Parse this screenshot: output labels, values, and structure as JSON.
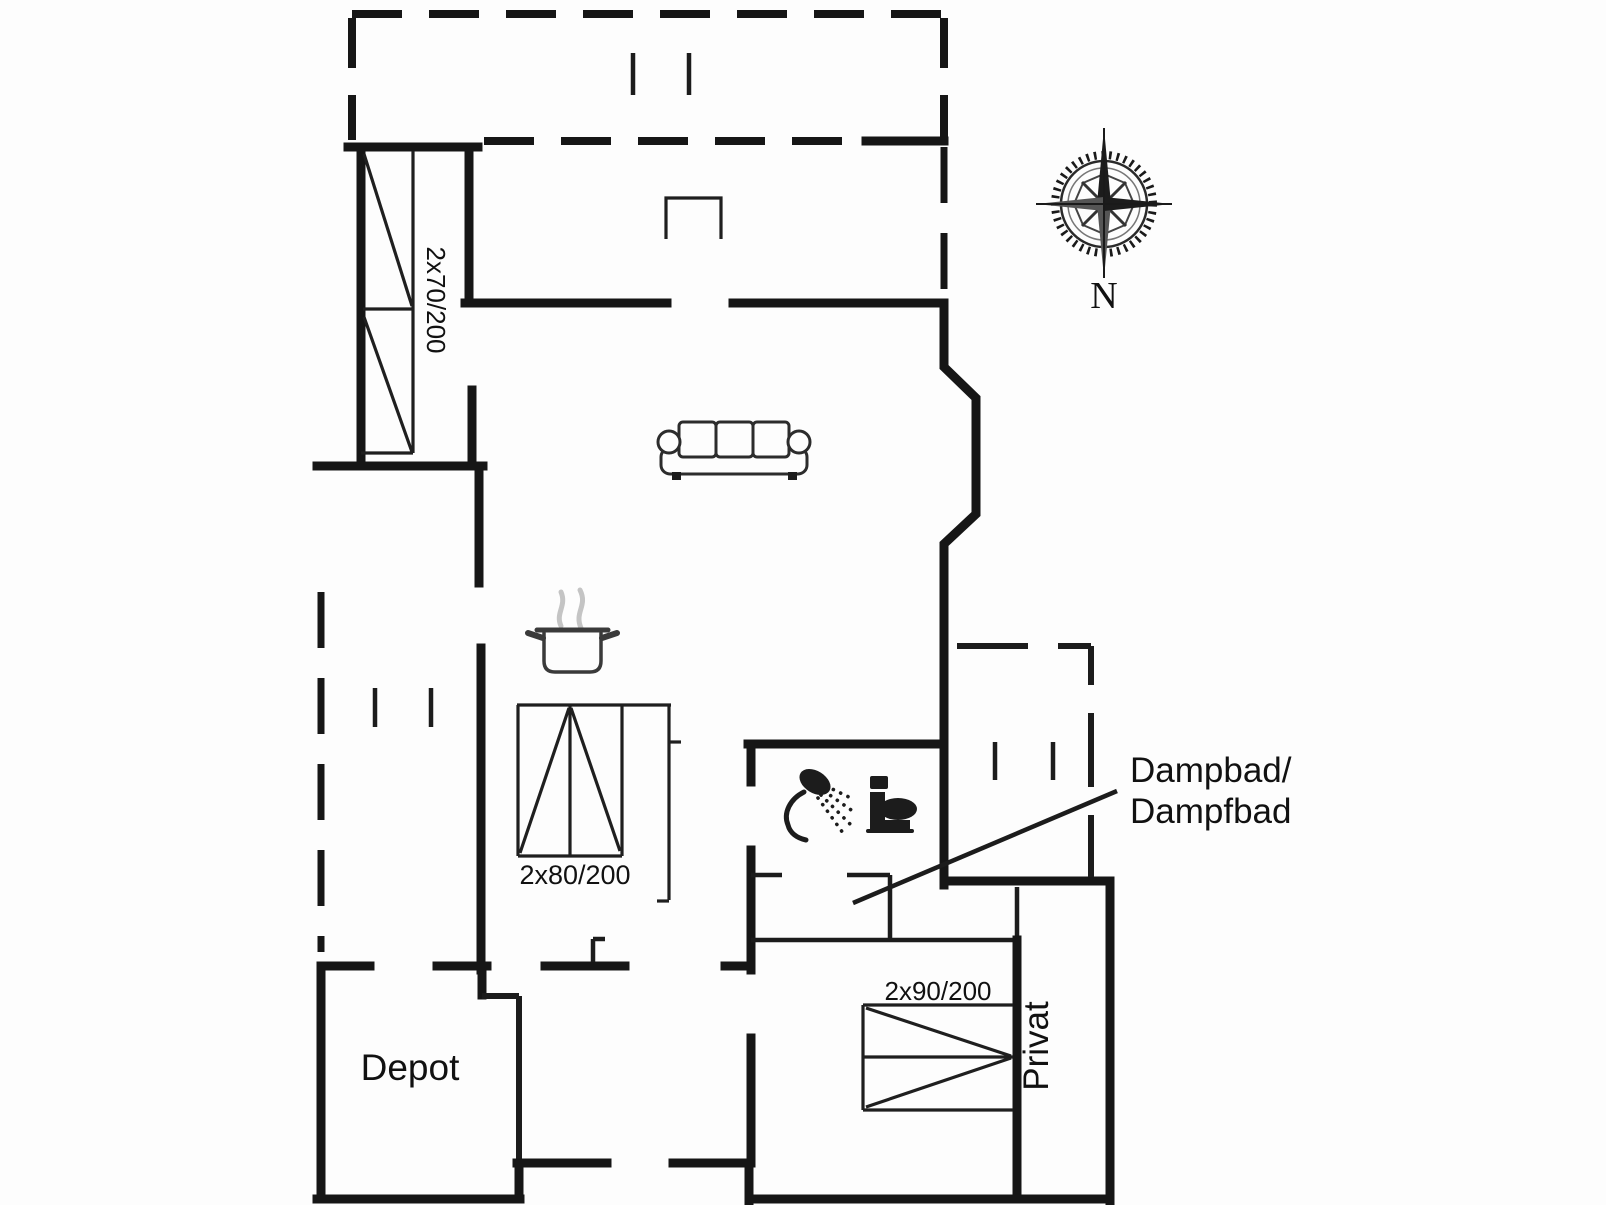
{
  "labels": {
    "window_left": "2x70/200",
    "bed_small": "2x80/200",
    "bed_large": "2x90/200",
    "room_depot": "Depot",
    "room_privat": "Privat",
    "annotation_line1": "Dampbad/",
    "annotation_line2": "Dampfbad",
    "compass_north": "N"
  },
  "icons": {
    "compass": "compass-rose-icon",
    "sofa": "sofa-icon",
    "stove": "cooking-pot-icon",
    "shower": "shower-icon",
    "toilet": "toilet-icon"
  },
  "colors": {
    "wall": "#161616",
    "background": "#fdfdfd",
    "steam": "#c4c4c4",
    "text": "#111111"
  }
}
